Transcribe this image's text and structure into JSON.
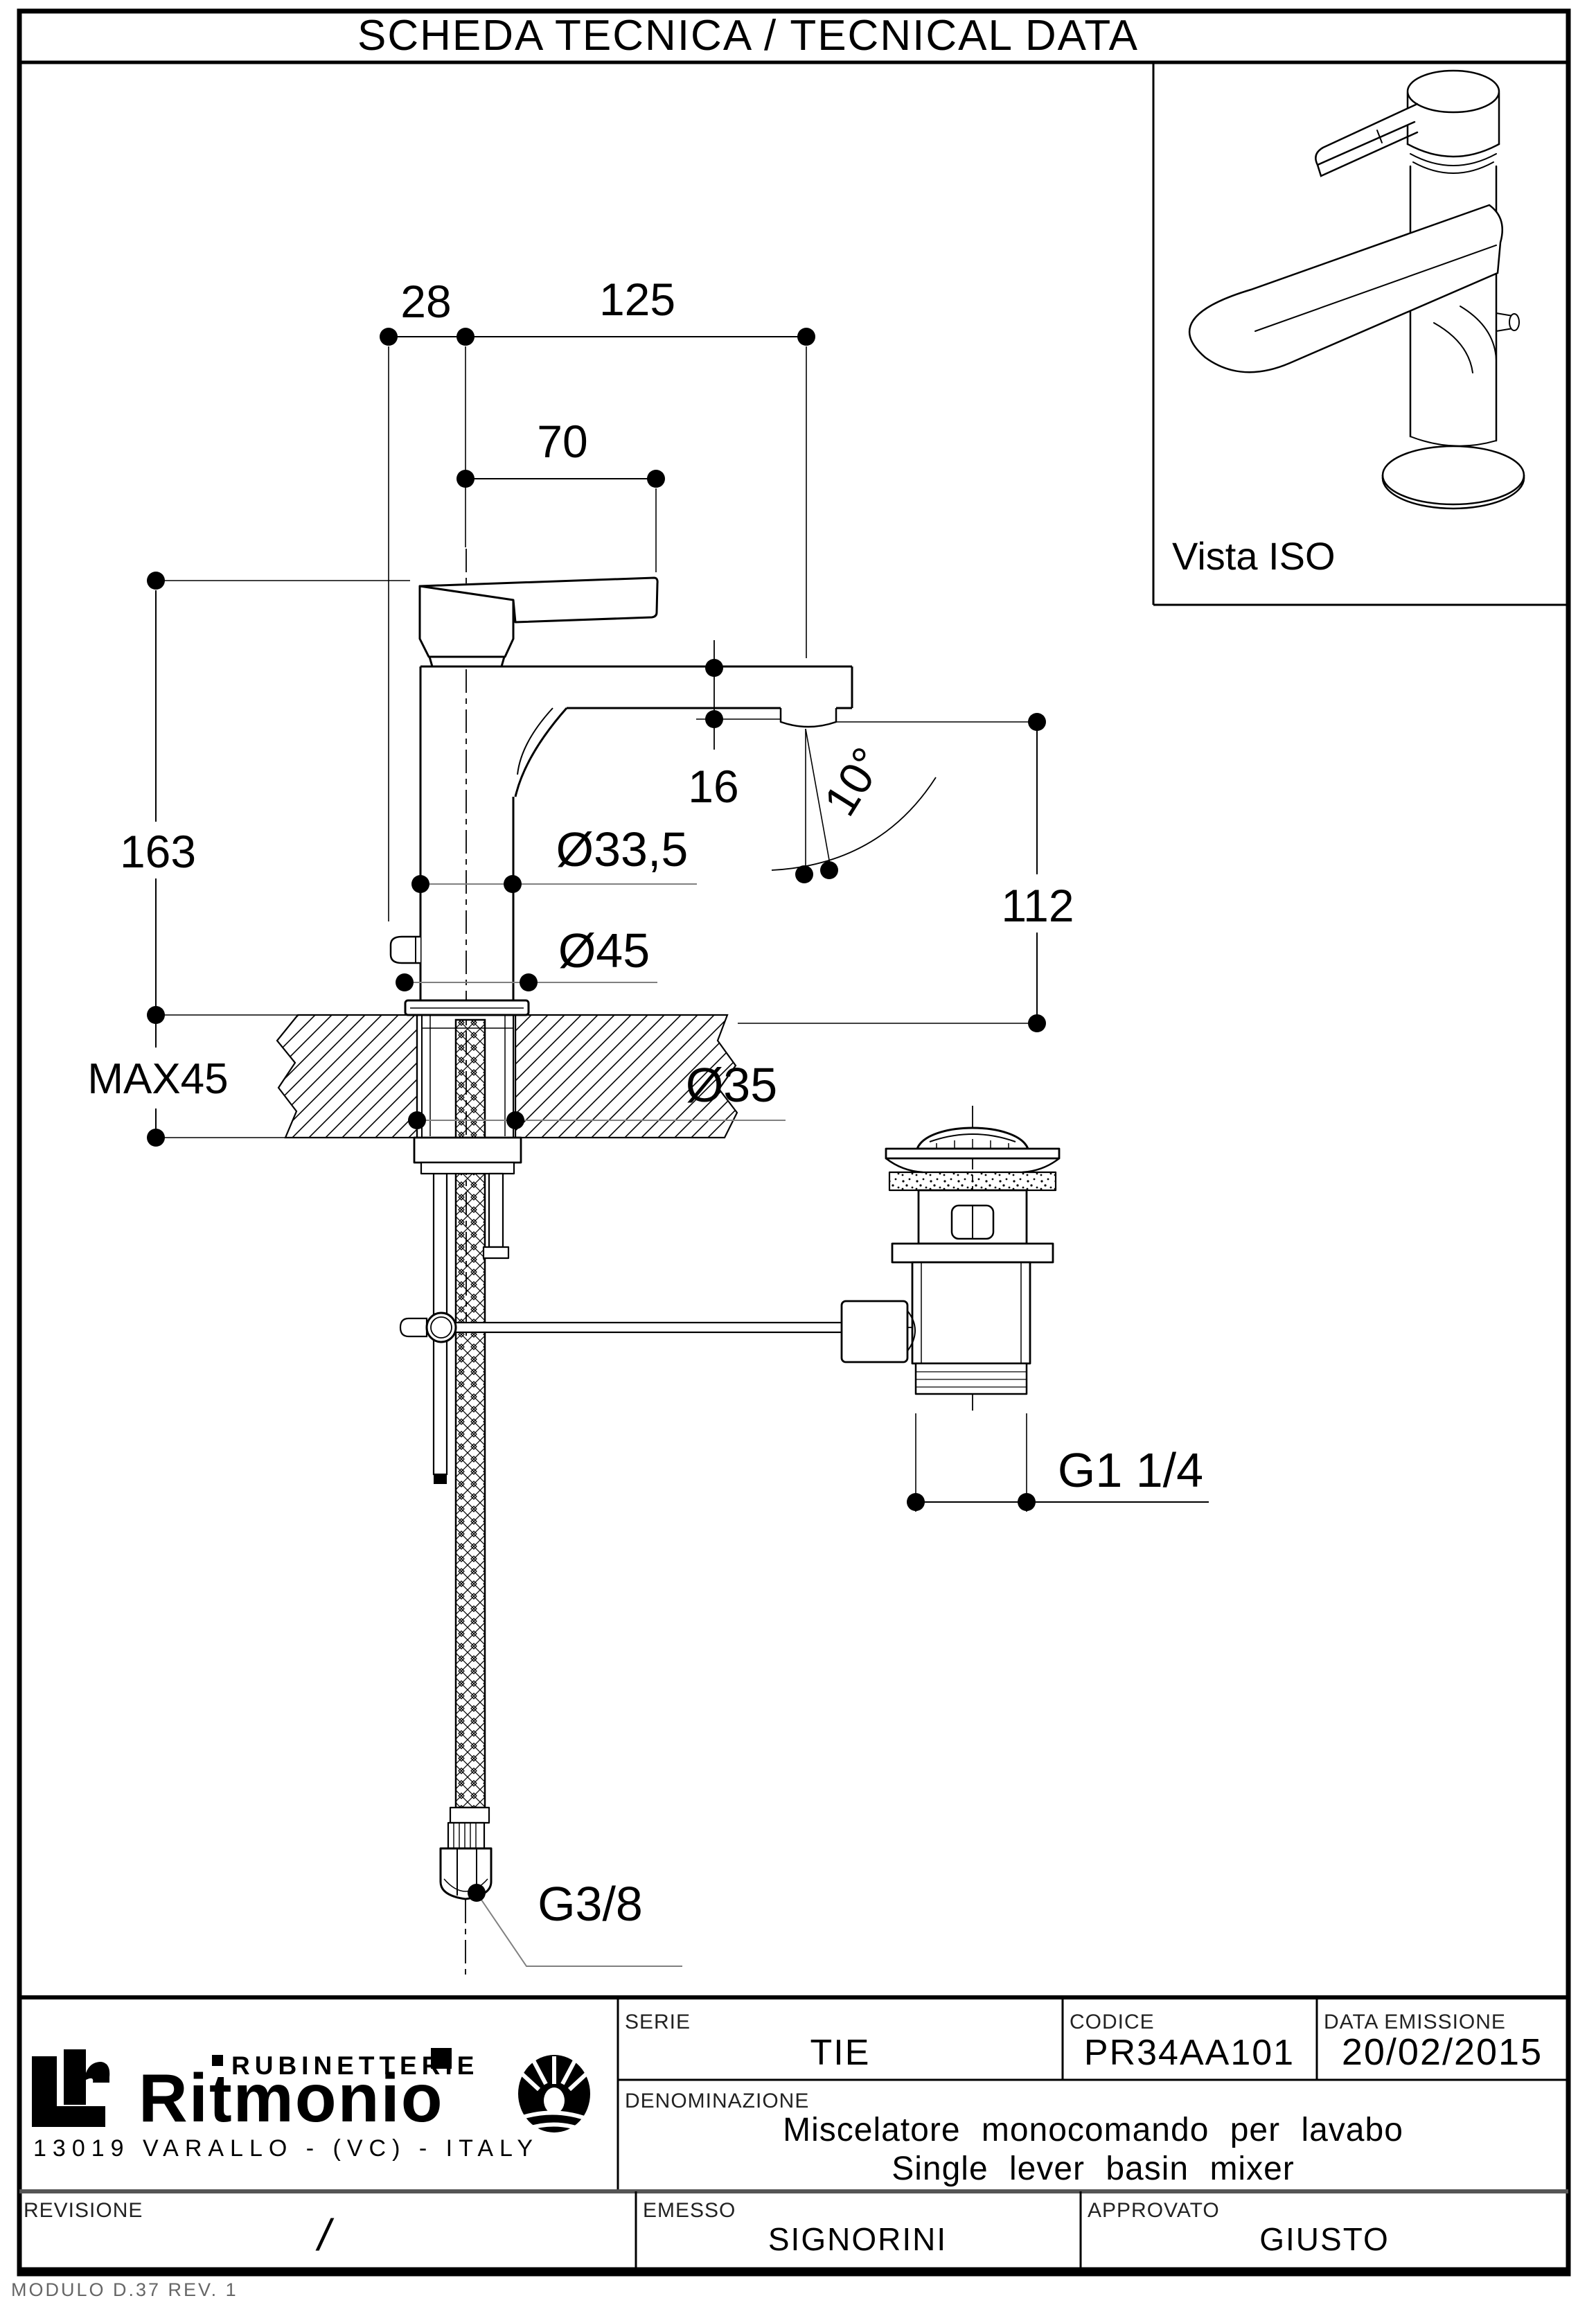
{
  "header": {
    "title": "SCHEDA TECNICA / TECNICAL DATA"
  },
  "iso_view": {
    "label": "Vista ISO"
  },
  "drawing": {
    "dims": {
      "d28": "28",
      "d125": "125",
      "d70": "70",
      "d163": "163",
      "max45": "MAX45",
      "d335": "Ø33,5",
      "d45": "Ø45",
      "d35": "Ø35",
      "d16": "16",
      "d10deg": "10°",
      "d112": "112",
      "g114": "G1 1/4",
      "g38": "G3/8"
    }
  },
  "title_block": {
    "serie_label": "SERIE",
    "serie_value": "TIE",
    "codice_label": "CODICE",
    "codice_value": "PR34AA101",
    "data_label": "DATA EMISSIONE",
    "data_value": "20/02/2015",
    "denominazione_label": "DENOMINAZIONE",
    "denominazione_line1": "Miscelatore monocomando per lavabo",
    "denominazione_line2": "Single lever basin mixer",
    "revisione_label": "REVISIONE",
    "revisione_value": "/",
    "emesso_label": "EMESSO",
    "emesso_value": "SIGNORINI",
    "approvato_label": "APPROVATO",
    "approvato_value": "GIUSTO"
  },
  "logo": {
    "sub": "RUBINETTERIE",
    "brand": "Ritmonio",
    "address": "13019 VARALLO - (VC) - ITALY"
  },
  "footer": {
    "modulo": "MODULO D.37 REV. 1"
  }
}
